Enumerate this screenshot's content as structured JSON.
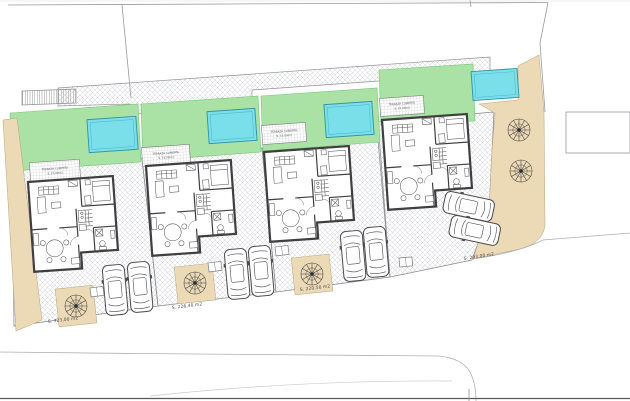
{
  "labels": {
    "plot_areas": [
      "S. 323,00 m2",
      "S. 226,40 m2",
      "S. 220,50 m2",
      "S. 293,00 m2"
    ],
    "terrace_line1": "TERRAZA CUBIERTA",
    "terrace_line2": "S. 15,00m2"
  },
  "colors": {
    "grass": "#a9e2a4",
    "pool_water": "#7bdfe9",
    "pool_edge": "#2f93a3",
    "sand": "#ecd9b5",
    "paving_hatch": "#cdced2",
    "wall": "#3f3f41",
    "boundary_line": "#9a9a9e",
    "street_line": "#aeb0b3"
  },
  "inventory": {
    "villas": 4,
    "pools": 4,
    "parked_cars": 8,
    "trees": 5,
    "covered_terraces": 4
  }
}
